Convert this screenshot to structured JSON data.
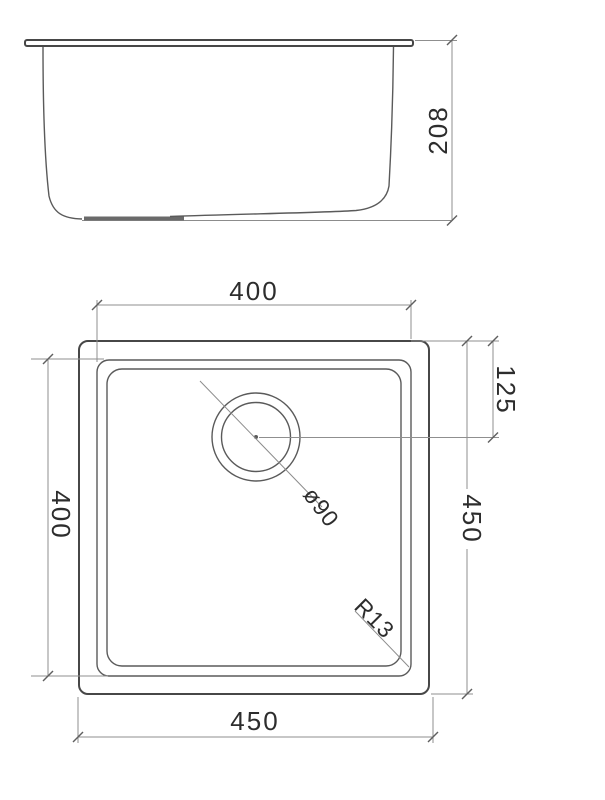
{
  "drawing": {
    "kind": "technical-dimension-drawing",
    "subject": "square undermount kitchen sink, two orthographic views",
    "colors": {
      "background": "#ffffff",
      "object_line": "#5a5a5a",
      "dimension_line": "#8f8f8f",
      "text": "#2d2d2d"
    },
    "side_view": {
      "name": "front elevation",
      "depth_label": "208"
    },
    "plan_view": {
      "name": "top plan",
      "top_width_label": "400",
      "left_height_label": "400",
      "drain_offset_label": "125",
      "right_height_label": "450",
      "bottom_width_label": "450",
      "drain_diameter_label": "ø90",
      "corner_radius_label": "R13"
    }
  }
}
